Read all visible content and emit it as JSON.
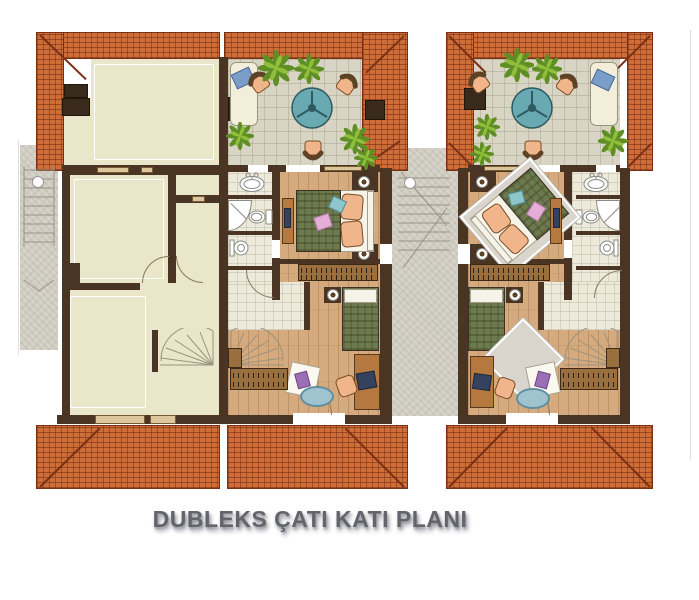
{
  "title": {
    "text": "DUBLEKS ÇATI KATI PLANI"
  },
  "palette": {
    "roof": "#cf6d38",
    "roof_edge": "#7a3014",
    "wall": "#4a3423",
    "beige": "#eae6c9",
    "wood": "#d4aa7e",
    "tile": "#d9d5c4",
    "bath": "#edeadb",
    "paving": "#d6d3c9",
    "window": "#dcc79d",
    "teal": "#68a9b2",
    "peach": "#f1b58c",
    "chair_back": "#5d4226",
    "plant_dark": "#5f8f24",
    "plant_light": "#8fbf3a",
    "plaid": "#6e7a4b",
    "mattress": "#f6f3e9",
    "pillow_blue": "#7b9dc9",
    "cushion_teal": "#8fc6cc",
    "cushion_pink": "#e5aed6",
    "cushion_purple": "#9a6fb5",
    "furniture_brown": "#9a6f3f",
    "desk": "#b5793f",
    "laptop": "#34425f",
    "rug_teal": "#9fc3cf",
    "rug_gray": "#d9d5cd",
    "fixture_line": "#8b8b85",
    "stair_line": "#9a937f",
    "title_color": "#64646d",
    "title_shadow": "#9c9ca6"
  },
  "plan": {
    "label": "duplex-attic-floor-plan",
    "units": [
      {
        "id": "unit-a",
        "rooms": [
          "open-attic-space",
          "roof-terrace",
          "master-bedroom",
          "bathroom",
          "bedroom",
          "stair-hall"
        ]
      },
      {
        "id": "unit-b",
        "rooms": [
          "roof-terrace",
          "master-bedroom",
          "bathroom",
          "bedroom",
          "stair-hall"
        ]
      }
    ],
    "icons": [
      "plant-icon",
      "table-icon",
      "chair-icon",
      "chaise-lounge-icon",
      "bed-icon",
      "wardrobe-icon",
      "desk-icon",
      "laptop-icon",
      "vanity-sink-icon",
      "pedestal-sink-icon",
      "toilet-icon",
      "shower-icon",
      "spiral-stair-icon",
      "stair-icon",
      "rug-icon",
      "lamp-icon",
      "column-icon"
    ]
  }
}
